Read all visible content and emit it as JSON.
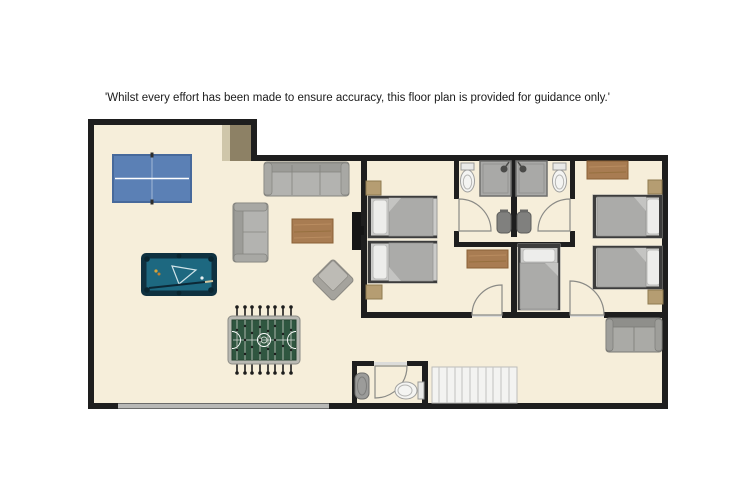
{
  "disclaimer": "'Whilst every effort has been made to ensure accuracy, this floor plan is provided for guidance only.'",
  "floor_plan": {
    "type": "apartment-floor-plan",
    "rooms": [
      {
        "id": "games-room",
        "furniture": [
          "table-tennis-table",
          "three-seat-sofa",
          "two-seat-sofa",
          "coffee-table",
          "wall-mounted-tv",
          "pool-table",
          "foosball-table",
          "armchair",
          "patio-window"
        ]
      },
      {
        "id": "bedroom-1",
        "furniture": [
          "twin-bed",
          "twin-bed",
          "nightstand",
          "nightstand",
          "dresser"
        ],
        "door": "south",
        "ensuite": "bathroom-1"
      },
      {
        "id": "bathroom-1",
        "furniture": [
          "toilet",
          "shower",
          "basin"
        ]
      },
      {
        "id": "bathroom-2",
        "furniture": [
          "shower",
          "toilet",
          "basin"
        ]
      },
      {
        "id": "bedroom-2",
        "furniture": [
          "single-bed",
          "twin-bed",
          "twin-bed",
          "dresser",
          "nightstand",
          "nightstand"
        ],
        "door": "south",
        "ensuite": "bathroom-2"
      },
      {
        "id": "hallway",
        "furniture": [
          "two-seat-sofa",
          "staircase"
        ]
      },
      {
        "id": "wc",
        "furniture": [
          "corner-basin",
          "toilet"
        ]
      }
    ],
    "colors": {
      "background": "#ffffff",
      "floor": "#f6eeda",
      "walls": "#1e1e1e",
      "table_tennis": "#5b80b5",
      "pool_table": "#1d6880",
      "foosball_field": "#2f5640",
      "wood": "#a87c52",
      "nightstand": "#b59d72",
      "sofa_gray": "#b3b3b0",
      "bed_gray": "#ababa9",
      "window_gray": "#b8b8b6"
    }
  }
}
